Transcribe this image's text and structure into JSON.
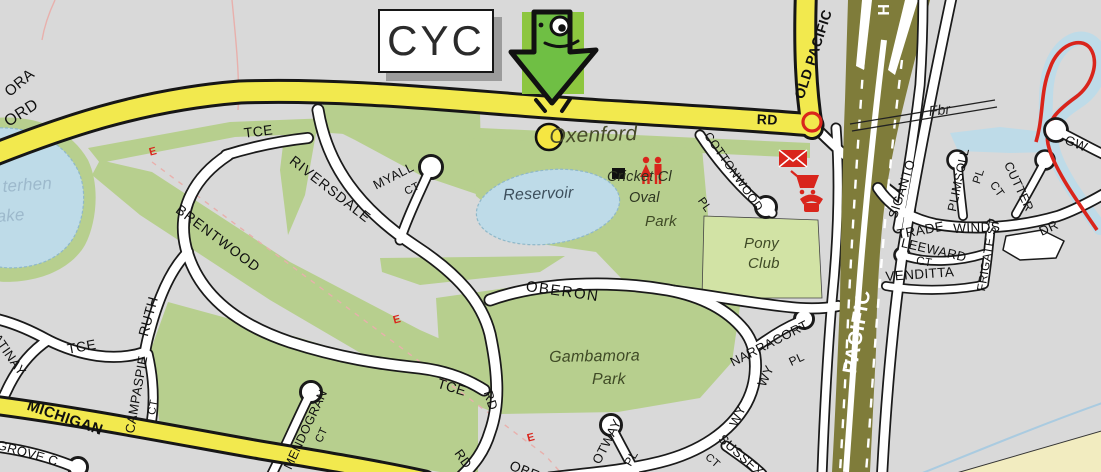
{
  "map": {
    "callout": {
      "label": "CYC"
    },
    "roads": {
      "partial_a": "ORA",
      "partial_b": "ORD",
      "old_pacific": "OLD PACIFIC",
      "rd_suffix": "RD",
      "hwy_partial": "H",
      "pacific": "PACIFIC",
      "michigan": "MICHIGAN",
      "lgrove_partial": "LGROVE C",
      "tce_upper": "TCE",
      "riversdale": "RIVERSDALE",
      "myall": "MYALL",
      "myall_suffix": "CT",
      "brentwood": "BRENTWOOD",
      "ruth": "RUTH",
      "campaspie": "CAMPASPIE",
      "campaspie_suffix": "CT",
      "tce_left": "TCE",
      "satinay": "SATINAY",
      "mendogran": "MENDOGRAN",
      "mendogran_suffix": "CT",
      "oberon": "OBERON",
      "oberon_partial": "OBE",
      "tce_mid": "TCE",
      "rd_mid": "RD",
      "rd_lower": "RD",
      "otway": "OTWAY",
      "otway_suffix": "PL",
      "sussex": "SUSSEX",
      "sussex_suffix": "CT",
      "wy_a": "WY",
      "wy_b": "WY",
      "narracort": "NARRACORT",
      "narracort_suffix": "PL",
      "cottonwood": "COTTONWOOD",
      "cottonwood_suffix": "PL",
      "siganto": "SIGANTO",
      "trade": "TRADE",
      "winds": "WINDS",
      "dr_suffix": "DR",
      "plimsoll": "PLIMSOLL",
      "plimsoll_suffix": "PL",
      "cutter": "CUTTER",
      "cutter_suffix": "CT",
      "leeward": "LEEWARD",
      "leeward_suffix": "CT",
      "frigate": "FRIGATE ST",
      "venditta": "VENDITTA",
      "gw_partial": "GW"
    },
    "places": {
      "locality": "Oxenford",
      "reservoir": "Reservoir",
      "cricket": "Cricket Cl",
      "oval": "Oval",
      "park": "Park",
      "pony_1": "Pony",
      "pony_2": "Club",
      "gambamora_1": "Gambamora",
      "gambamora_2": "Park",
      "lake_partial_1": "terhen",
      "lake_partial_2": "ake",
      "footbridge": "Fbr"
    },
    "markers": {
      "easement": "E"
    },
    "icons": {
      "pointer": "cyc-arrow-icon",
      "location": "yellow-dot-icon",
      "junction": "red-ring-icon",
      "post_office": "envelope-icon",
      "shopping": "cart-icon",
      "telephone": "phone-icon",
      "toilets": "toilets-icon",
      "building": "building-square-icon"
    },
    "colors": {
      "background": "#d9d9d9",
      "yellow_road": "#f2e94e",
      "park_green": "#b7cf8e",
      "pony_green": "#d2e3a5",
      "water_blue": "#bedbe8",
      "motorway_olive": "#7f7c3a",
      "marker_red": "#d9251c",
      "arrow_green": "#6fbf44",
      "arrow_square_green": "#8dc63f"
    }
  }
}
